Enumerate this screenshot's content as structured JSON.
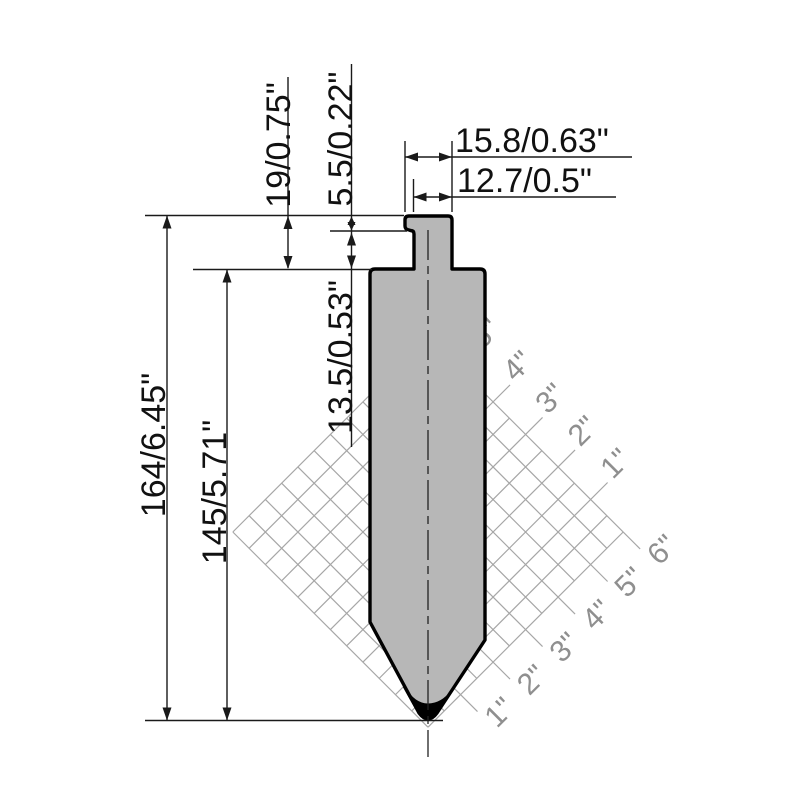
{
  "dimensions": {
    "total_height": "164/6.45\"",
    "body_height": "145/5.71\"",
    "tang_height": "19/0.75\"",
    "tang_step_depth": "5.5/0.22\"",
    "shank_below_step": "13.5/0.53\"",
    "tang_top_width": "15.8/0.63\"",
    "shank_width": "12.7/0.5\""
  },
  "scale_ruler": {
    "ne_edge_labels": [
      "5\"",
      "4\"",
      "3\"",
      "2\"",
      "1\""
    ],
    "se_edge_labels": [
      "6\"",
      "5\"",
      "4\"",
      "3\"",
      "2\"",
      "1\""
    ]
  },
  "colors": {
    "background": "#ffffff",
    "punch_fill": "#b7b7b7",
    "punch_outline": "#000000",
    "tip_fill": "#000000",
    "grid_line": "#a6a6a6",
    "grid_text": "#8f8f8f",
    "dim_line": "#1a1a1a"
  }
}
